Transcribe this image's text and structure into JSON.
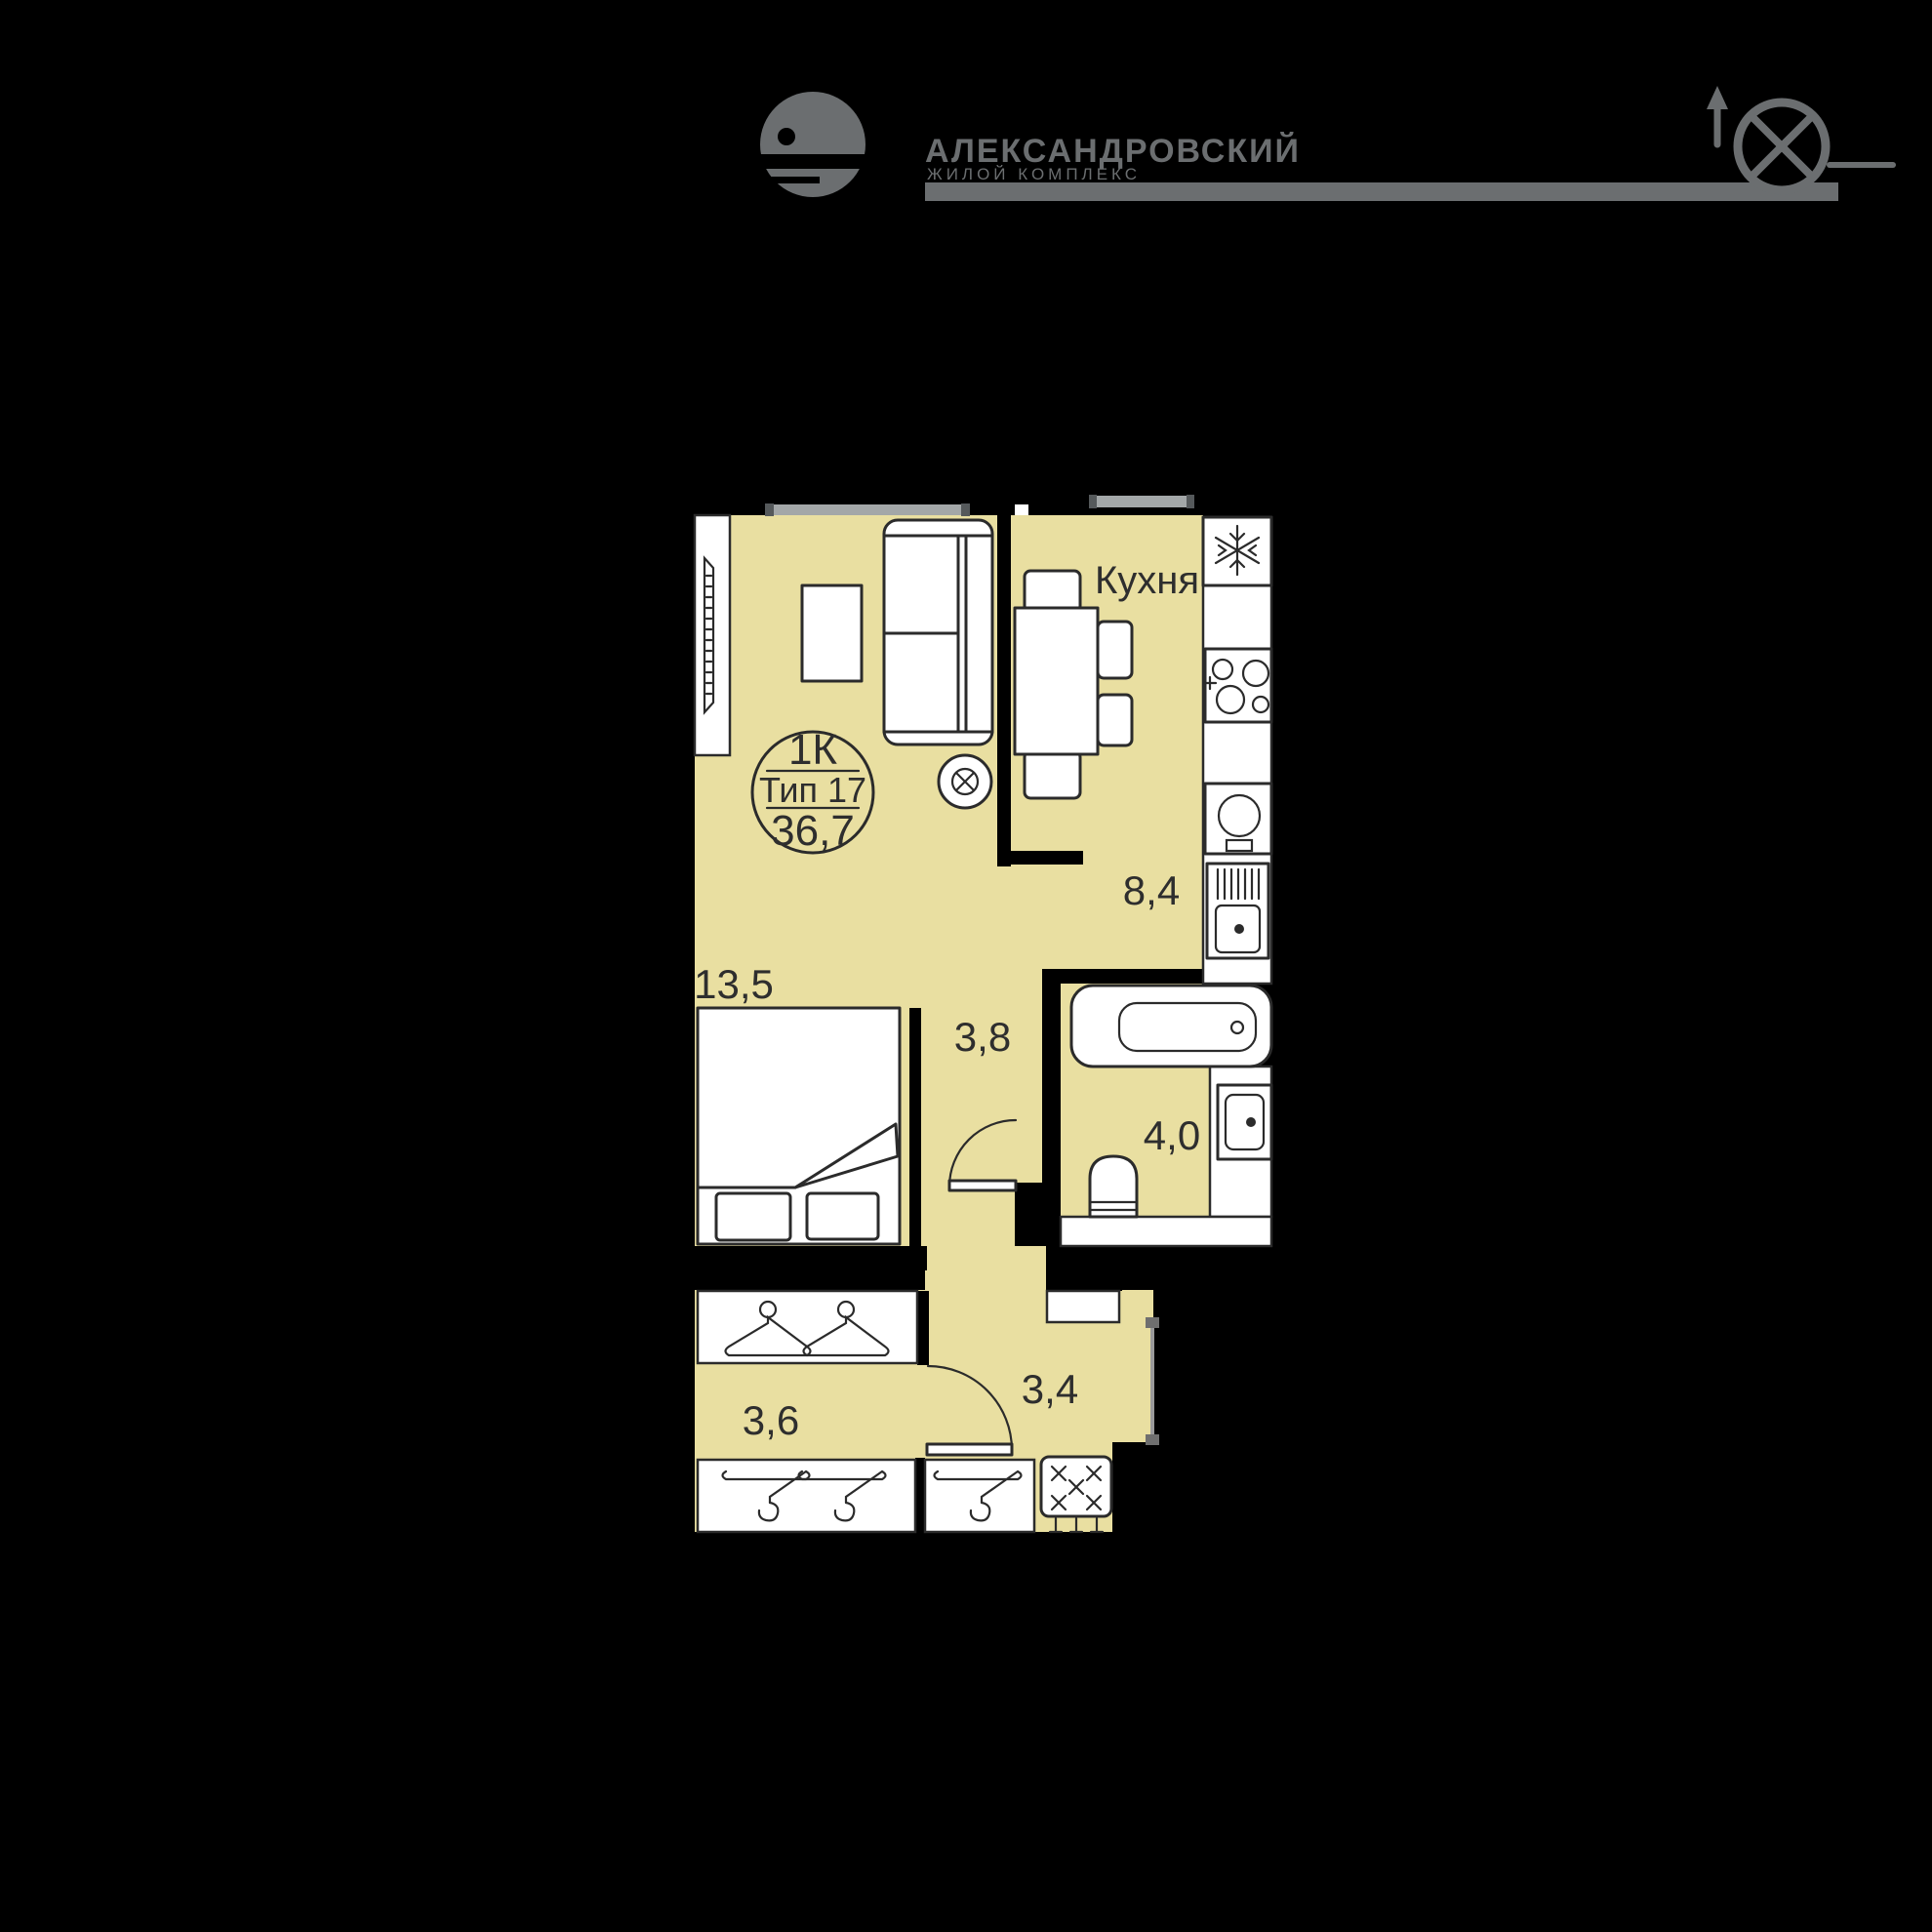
{
  "header": {
    "brand_line1": "АЛЕКСАНДРОВСКИЙ",
    "brand_line2": "ЖИЛОЙ КОМПЛЕКС"
  },
  "plan": {
    "badge": {
      "rooms": "1К",
      "type": "Тип 17",
      "area": "36,7"
    },
    "labels": {
      "kitchen_name": "Кухня",
      "kitchen_area": "8,4",
      "living_area": "13,5",
      "hall_area": "3,8",
      "bath_area": "4,0",
      "corridor_area": "3,4",
      "wardrobe_area": "3,6"
    },
    "colors": {
      "floor": "#e9dfa1",
      "outline": "#2b2b2b",
      "brand_gray": "#6b6e70",
      "window_gray": "#a3a7a8",
      "background": "#000000"
    }
  }
}
